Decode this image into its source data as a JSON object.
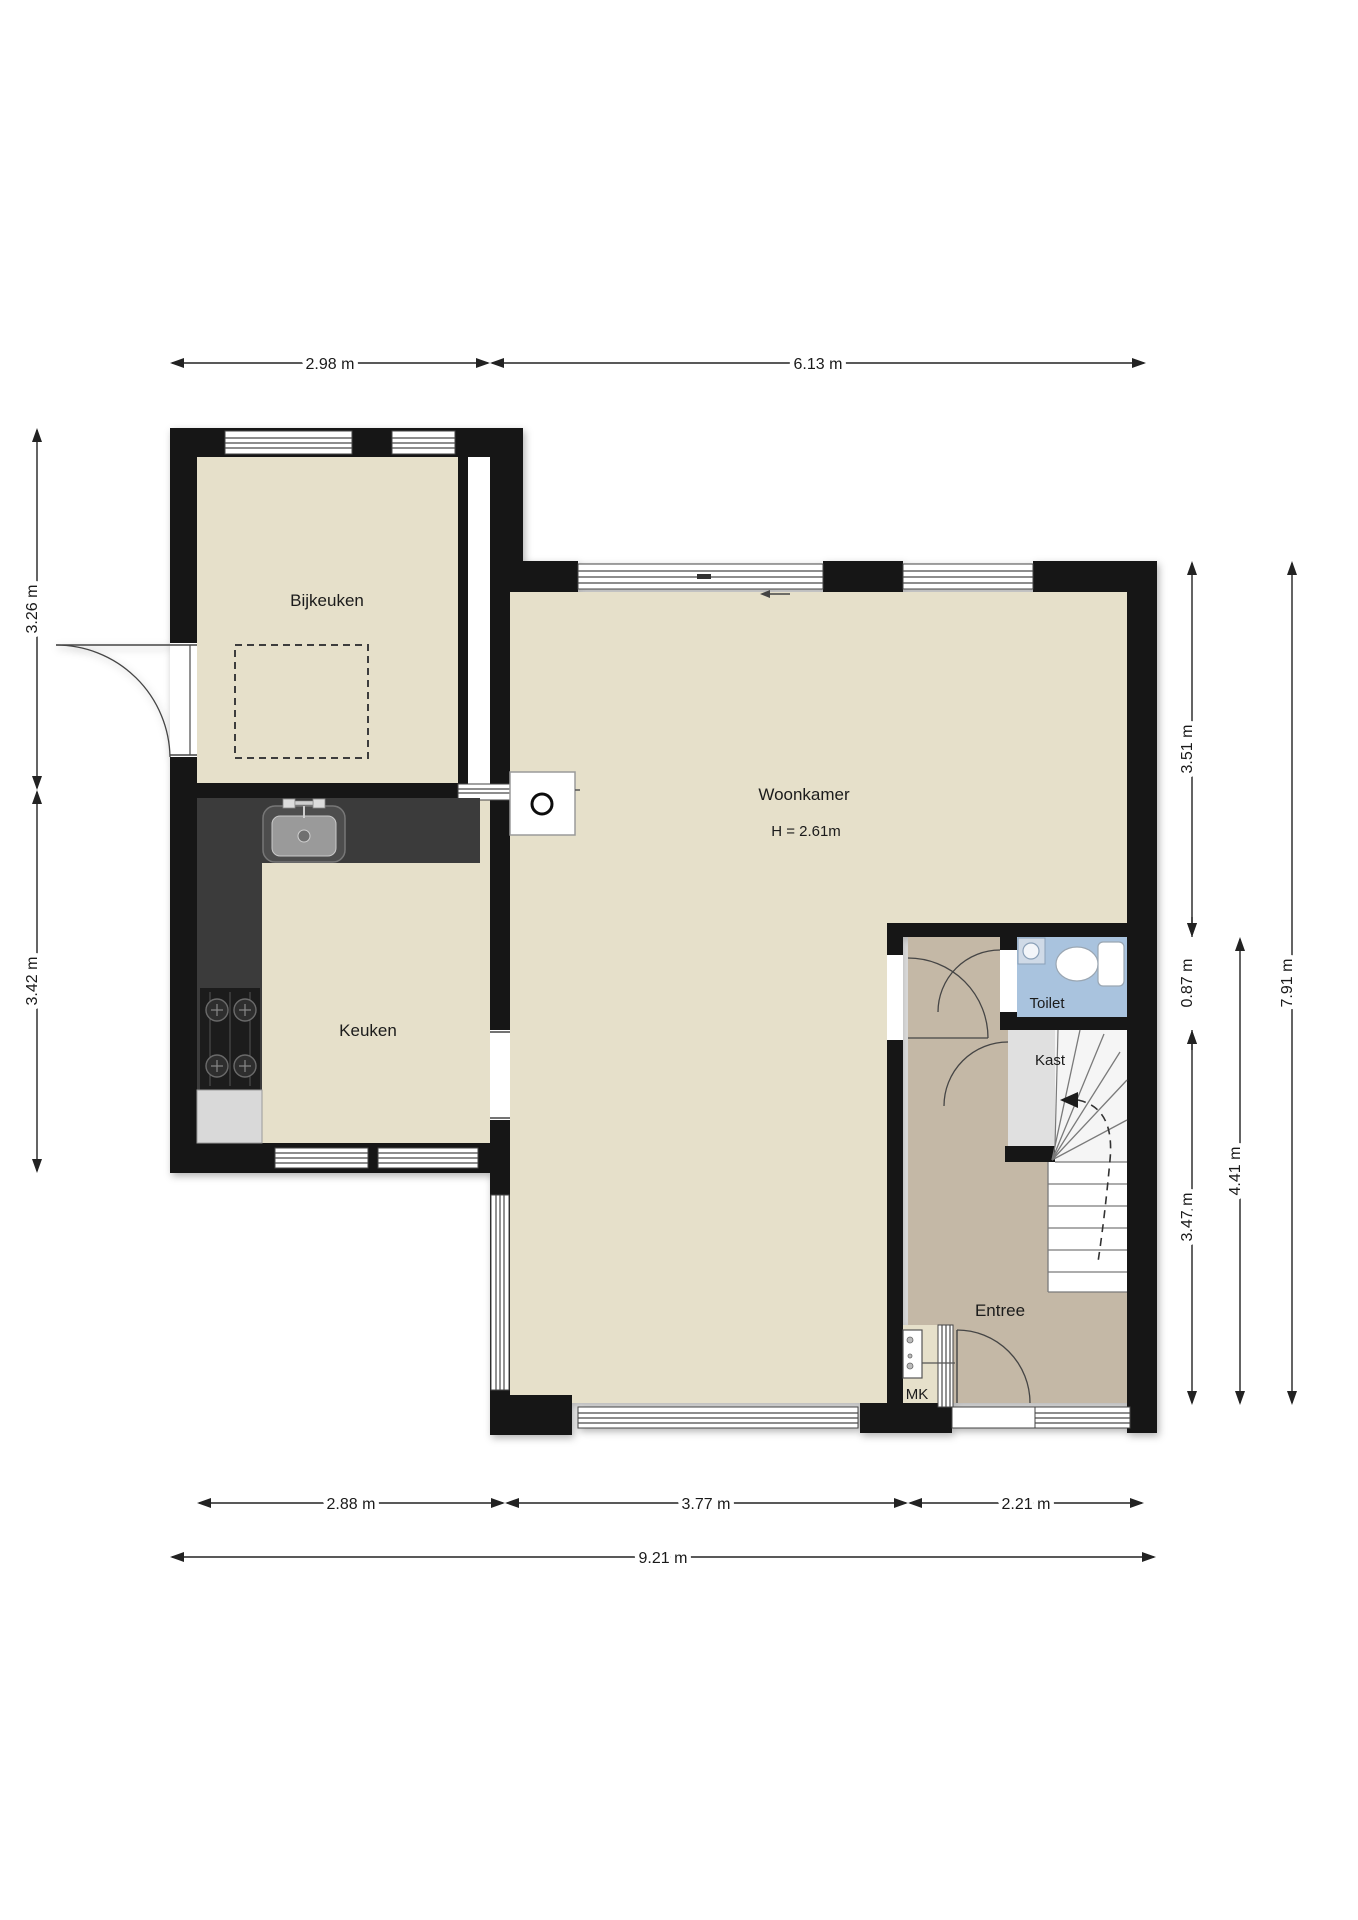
{
  "plan": {
    "rooms": {
      "bijkeuken": "Bijkeuken",
      "keuken": "Keuken",
      "woonkamer": "Woonkamer",
      "woonkamer_height": "H = 2.61m",
      "toilet": "Toilet",
      "kast": "Kast",
      "entree": "Entree",
      "mk": "MK"
    },
    "dimensions": {
      "top": [
        "2.98 m",
        "6.13 m"
      ],
      "left": [
        "3.26 m",
        "3.42 m"
      ],
      "right": [
        "3.51 m",
        "0.87 m",
        "3.47 m",
        "4.41 m",
        "7.91 m"
      ],
      "bottom": [
        "2.88 m",
        "3.77 m",
        "2.21 m"
      ],
      "overall_bottom": "9.21 m"
    },
    "colors": {
      "wall": "#141414",
      "room_floor": "#e6e0ca",
      "entree_floor": "#c4b8a6",
      "toilet_floor": "#a9c3de",
      "kast_floor": "#e0e0e0",
      "counter": "#3a3a3a",
      "stove": "#1c1c1c",
      "fridge": "#d9d9d9",
      "dimension_text": "#1a1a1a"
    }
  }
}
